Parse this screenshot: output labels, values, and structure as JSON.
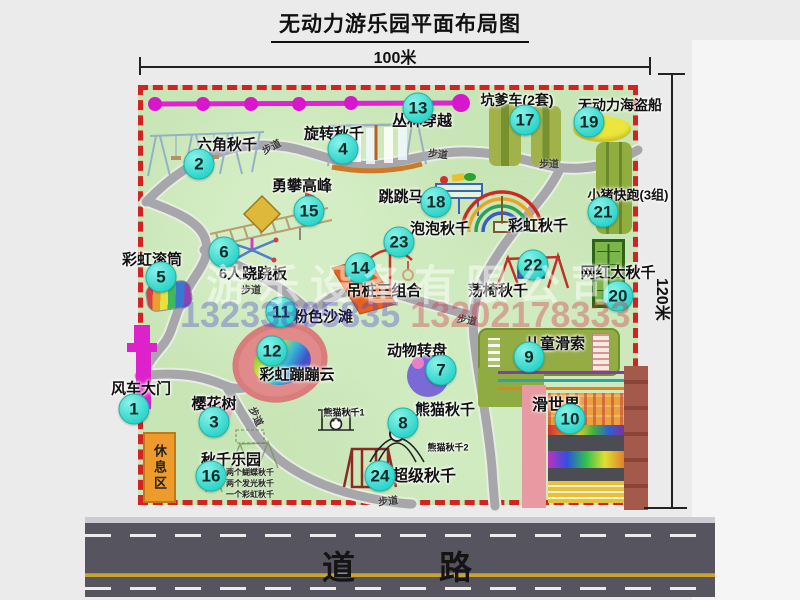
{
  "title": "无动力游乐园平面布局图",
  "dimensions": {
    "width": "100米",
    "height": "120米"
  },
  "road": {
    "label": "道　　路"
  },
  "rest_area": {
    "label": "休息区"
  },
  "watermark": {
    "company": "游乐设备有限公司",
    "phone1": "13233805835",
    "phone2": "13202178333"
  },
  "path_label_text": "步道",
  "attractions": [
    {
      "num": "1",
      "name": "风车大门",
      "bx": 134,
      "by": 409,
      "lx": 141,
      "ly": 388
    },
    {
      "num": "2",
      "name": "六角秋千",
      "bx": 199,
      "by": 164,
      "lx": 227,
      "ly": 144
    },
    {
      "num": "3",
      "name": "樱花树",
      "bx": 214,
      "by": 422,
      "lx": 214,
      "ly": 403
    },
    {
      "num": "4",
      "name": "旋转秋千",
      "bx": 343,
      "by": 149,
      "lx": 334,
      "ly": 133
    },
    {
      "num": "5",
      "name": "彩虹滚筒",
      "bx": 161,
      "by": 277,
      "lx": 152,
      "ly": 259
    },
    {
      "num": "6",
      "name": "6人跷跷板",
      "bx": 224,
      "by": 252,
      "lx": 253,
      "ly": 273
    },
    {
      "num": "7",
      "name": "动物转盘",
      "bx": 441,
      "by": 370,
      "lx": 417,
      "ly": 350
    },
    {
      "num": "8",
      "name": "熊猫秋千",
      "bx": 403,
      "by": 423,
      "lx": 445,
      "ly": 409
    },
    {
      "num": "9",
      "name": "儿童滑索",
      "bx": 529,
      "by": 357,
      "lx": 555,
      "ly": 343
    },
    {
      "num": "10",
      "name": "滑世界",
      "bx": 570,
      "by": 419,
      "lx": 556,
      "ly": 403,
      "fs": 16
    },
    {
      "num": "11",
      "name": "粉色沙滩",
      "bx": 281,
      "by": 312,
      "lx": 323,
      "ly": 316
    },
    {
      "num": "12",
      "name": "彩虹蹦蹦云",
      "bx": 272,
      "by": 351,
      "lx": 297,
      "ly": 374
    },
    {
      "num": "13",
      "name": "丛林穿越",
      "bx": 418,
      "by": 108,
      "lx": 422,
      "ly": 120
    },
    {
      "num": "14",
      "name": "吊桩三组合",
      "bx": 360,
      "by": 268,
      "lx": 384,
      "ly": 290
    },
    {
      "num": "15",
      "name": "勇攀高峰",
      "bx": 309,
      "by": 211,
      "lx": 302,
      "ly": 185
    },
    {
      "num": "16",
      "name": "秋千乐园",
      "bx": 211,
      "by": 476,
      "lx": 231,
      "ly": 459
    },
    {
      "num": "17",
      "name": "坑爹车(2套)",
      "bx": 525,
      "by": 120,
      "lx": 517,
      "ly": 100,
      "fs": 14
    },
    {
      "num": "18",
      "name": "跳跳马",
      "bx": 436,
      "by": 202,
      "lx": 401,
      "ly": 196
    },
    {
      "num": "19",
      "name": "无动力海盗船",
      "bx": 589,
      "by": 122,
      "lx": 620,
      "ly": 105,
      "fs": 14
    },
    {
      "num": "20",
      "name": "网红大秋千",
      "bx": 618,
      "by": 296,
      "lx": 618,
      "ly": 272
    },
    {
      "num": "21",
      "name": "小猪快跑(3组)",
      "bx": 603,
      "by": 212,
      "lx": 628,
      "ly": 194,
      "fs": 13
    },
    {
      "num": "22",
      "name": "荡椅秋千",
      "bx": 533,
      "by": 265,
      "lx": 498,
      "ly": 290
    },
    {
      "num": "23",
      "name": "泡泡秋千",
      "bx": 399,
      "by": 242,
      "lx": 440,
      "ly": 228
    },
    {
      "num": "24",
      "name": "超级秋千",
      "bx": 380,
      "by": 476,
      "lx": 424,
      "ly": 474,
      "fs": 16
    }
  ],
  "extra_labels": [
    {
      "text": "彩虹秋千",
      "x": 538,
      "y": 225,
      "fs": 15
    },
    {
      "text": "熊猫秋千1",
      "x": 344,
      "y": 412,
      "fs": 9
    },
    {
      "text": "熊猫秋千2",
      "x": 448,
      "y": 447,
      "fs": 9
    }
  ],
  "swing_park_notes": [
    "两个蝴蝶秋千",
    "两个发光秋千",
    "一个彩虹秋千"
  ],
  "path_labels": [
    {
      "x": 271,
      "y": 146,
      "r": -28
    },
    {
      "x": 438,
      "y": 153,
      "r": 6
    },
    {
      "x": 549,
      "y": 163,
      "r": 0
    },
    {
      "x": 251,
      "y": 289,
      "r": 0
    },
    {
      "x": 467,
      "y": 319,
      "r": 10
    },
    {
      "x": 257,
      "y": 416,
      "r": 65
    },
    {
      "x": 388,
      "y": 500,
      "r": -6
    }
  ]
}
